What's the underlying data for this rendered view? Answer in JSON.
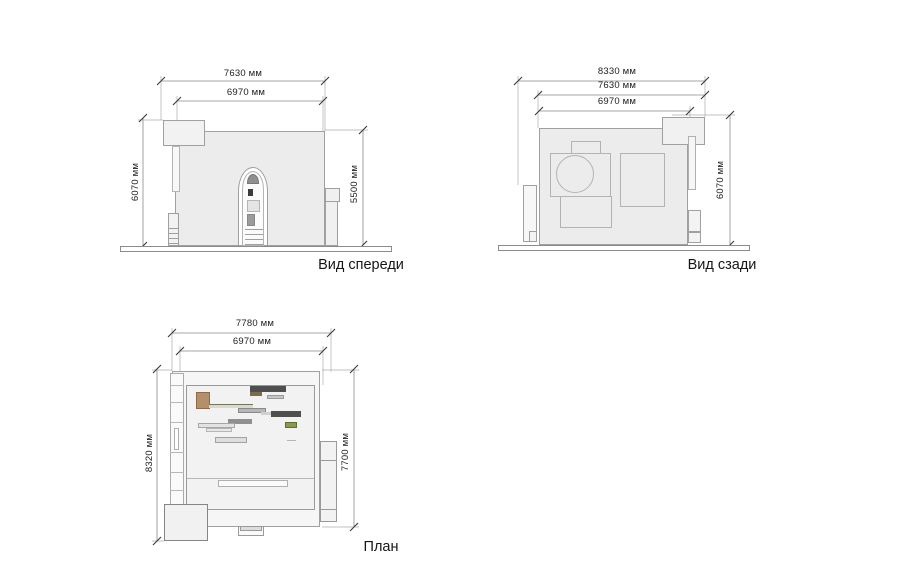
{
  "drawing": {
    "type": "architectural-elevations-and-plan",
    "unit": "мм",
    "views": [
      {
        "id": "front",
        "label": "Вид спереди",
        "dims": {
          "top_outer": "7630 мм",
          "top_inner": "6970 мм",
          "left": "6070 мм",
          "right": "5500 мм"
        }
      },
      {
        "id": "rear",
        "label": "Вид сзади",
        "dims": {
          "top_outer": "8330 мм",
          "top_mid": "7630 мм",
          "top_inner": "6970 мм",
          "right": "6070 мм"
        }
      },
      {
        "id": "plan",
        "label": "План",
        "dims": {
          "top_outer": "7780 мм",
          "top_inner": "6970 мм",
          "left": "8320 мм",
          "right": "7700 мм"
        }
      }
    ],
    "colors": {
      "background": "#ffffff",
      "wall_fill": "#ececec",
      "roof_fill": "#f6f6f6",
      "outline": "#a0a0a0",
      "dimension_line": "#8a8a8a",
      "tick": "#3a3a3a",
      "text": "#1c1c1c",
      "furniture_dark": "#4f4f4f",
      "furniture_tan": "#b3906a",
      "furniture_brown": "#7d6a50",
      "furniture_green": "#8a9a4c",
      "furniture_gray": "#b0b0b0"
    }
  }
}
